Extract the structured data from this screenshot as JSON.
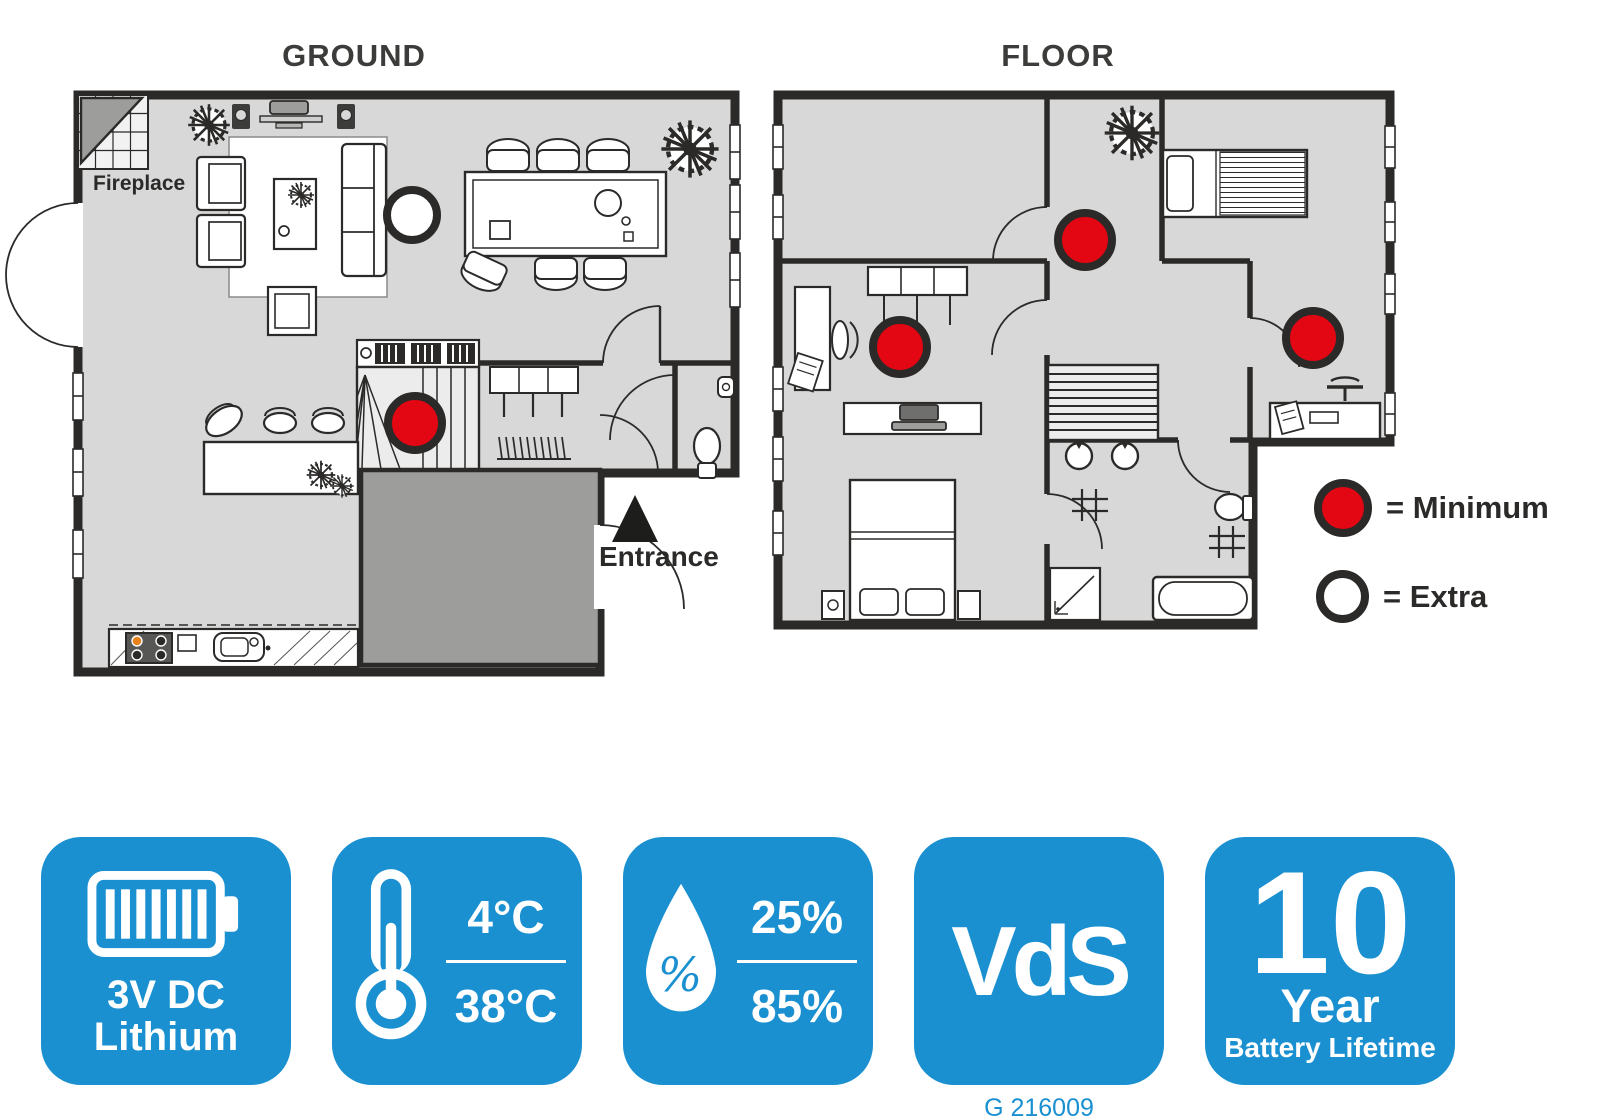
{
  "titles": {
    "ground": "GROUND",
    "floor": "FLOOR"
  },
  "floor_plans": {
    "ground": {
      "labels": {
        "fireplace": "Fireplace",
        "entrance": "Entrance"
      },
      "detectors": [
        {
          "kind": "minimum",
          "x": 337,
          "y": 328,
          "r": 27
        },
        {
          "kind": "extra",
          "x": 334,
          "y": 120,
          "r": 25
        }
      ]
    },
    "floor": {
      "detectors": [
        {
          "kind": "minimum",
          "x": 307,
          "y": 145,
          "r": 27
        },
        {
          "kind": "minimum",
          "x": 122,
          "y": 252,
          "r": 27
        },
        {
          "kind": "minimum",
          "x": 535,
          "y": 243,
          "r": 27
        }
      ]
    }
  },
  "legend": {
    "minimum": {
      "label": "= Minimum",
      "color": "#e30613"
    },
    "extra": {
      "label": "= Extra",
      "color": "#ffffff"
    }
  },
  "badges": [
    {
      "name": "power-supply",
      "icon": "battery-icon",
      "line1": "3V DC",
      "line2": "Lithium"
    },
    {
      "name": "temperature-range",
      "icon": "thermometer-icon",
      "top": "4°C",
      "bottom": "38°C"
    },
    {
      "name": "humidity-range",
      "icon": "humidity-drop-icon",
      "symbol": "%",
      "top": "25%",
      "bottom": "85%"
    },
    {
      "name": "vds-certification",
      "text": "VdS"
    },
    {
      "name": "battery-lifetime",
      "number": "10",
      "unit": "Year",
      "caption": "Battery Lifetime"
    }
  ],
  "footnote": "G 216009",
  "colors": {
    "badge_blue": "#1a90d1",
    "detector_red": "#e30613",
    "floor_gray": "#d8d8d8",
    "hall_gray": "#9d9d9c",
    "wall_dark": "#2b2a29"
  }
}
